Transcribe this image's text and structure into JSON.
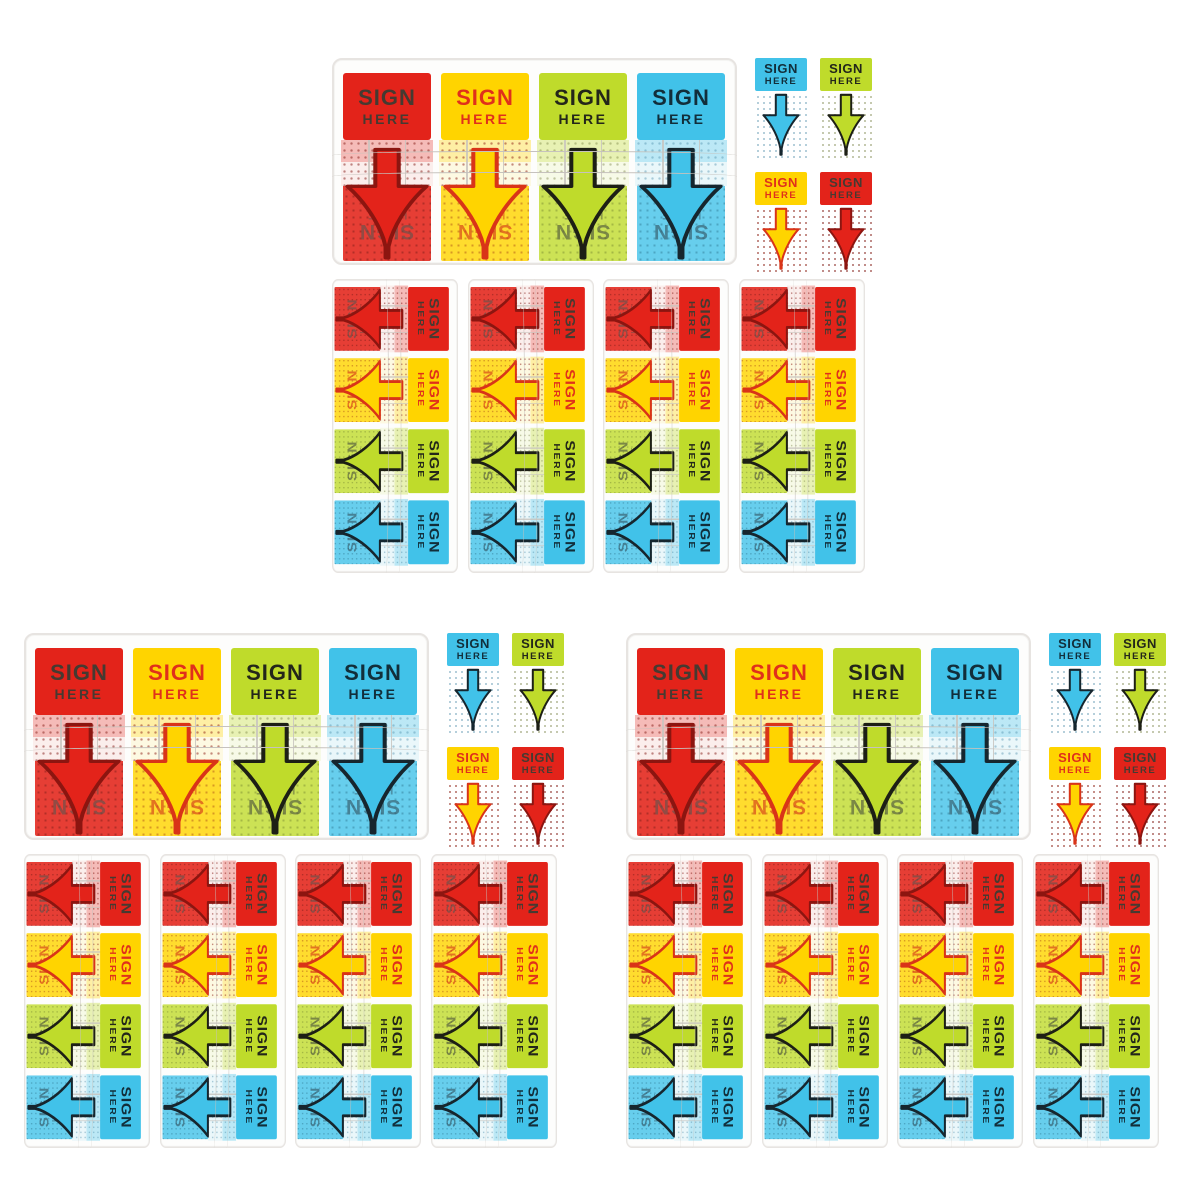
{
  "product": {
    "label": {
      "line1": "SIGN",
      "line2": "HERE"
    },
    "variants": [
      {
        "id": "red",
        "tab_bg": "#e3231a",
        "label_color": "#463a31",
        "arrow_fill": "#e3231a",
        "arrow_stroke": "#8c1510",
        "reversed_label_color": "#5b544e",
        "band_tint": "rgba(227,35,25,0.30)",
        "mid_tint": "rgba(227,35,25,0.07)",
        "stack_tint": "rgba(227,35,25,0.88)",
        "dot_color": "rgba(130,25,20,0.50)",
        "dot_on_color": "rgba(60,8,6,0.30)"
      },
      {
        "id": "yellow",
        "tab_bg": "#ffd400",
        "label_color": "#e0301b",
        "arrow_fill": "#ffd400",
        "arrow_stroke": "#d93418",
        "reversed_label_color": "#d23018",
        "band_tint": "rgba(255,212,0,0.35)",
        "mid_tint": "rgba(255,212,0,0.10)",
        "stack_tint": "rgba(255,212,0,0.82)",
        "dot_color": "rgba(140,30,18,0.50)",
        "dot_on_color": "rgba(150,40,15,0.38)"
      },
      {
        "id": "green",
        "tab_bg": "#bfdb2b",
        "label_color": "#23261a",
        "arrow_fill": "#bfdb2b",
        "arrow_stroke": "#1d1f15",
        "reversed_label_color": "#474d3c",
        "band_tint": "rgba(191,219,43,0.35)",
        "mid_tint": "rgba(191,219,43,0.10)",
        "stack_tint": "rgba(191,219,43,0.80)",
        "dot_color": "rgba(110,120,55,0.40)",
        "dot_on_color": "rgba(80,95,30,0.32)"
      },
      {
        "id": "blue",
        "tab_bg": "#41c2e9",
        "label_color": "#122e3a",
        "arrow_fill": "#41c2e9",
        "arrow_stroke": "#16262e",
        "reversed_label_color": "#31505e",
        "band_tint": "rgba(65,194,233,0.35)",
        "mid_tint": "rgba(65,194,233,0.10)",
        "stack_tint": "rgba(65,194,233,0.80)",
        "dot_color": "rgba(70,135,165,0.40)",
        "dot_on_color": "rgba(20,80,105,0.32)"
      }
    ],
    "dispenser_order": [
      "red",
      "yellow",
      "green",
      "blue"
    ],
    "grid_order": [
      "blue",
      "green",
      "yellow",
      "red"
    ],
    "strip_count": 4
  },
  "scene": {
    "background": "#ffffff",
    "tray": {
      "body_color": "#fdfdfc",
      "border_color": "#e7e4e1",
      "line_color": "#c6c2bd"
    },
    "sets": [
      {
        "id": "top",
        "x": 332,
        "y": 53
      },
      {
        "id": "bottom-left",
        "x": 24,
        "y": 628
      },
      {
        "id": "bottom-right",
        "x": 626,
        "y": 628
      }
    ],
    "strip_offsets": [
      0,
      136,
      271,
      407
    ]
  }
}
